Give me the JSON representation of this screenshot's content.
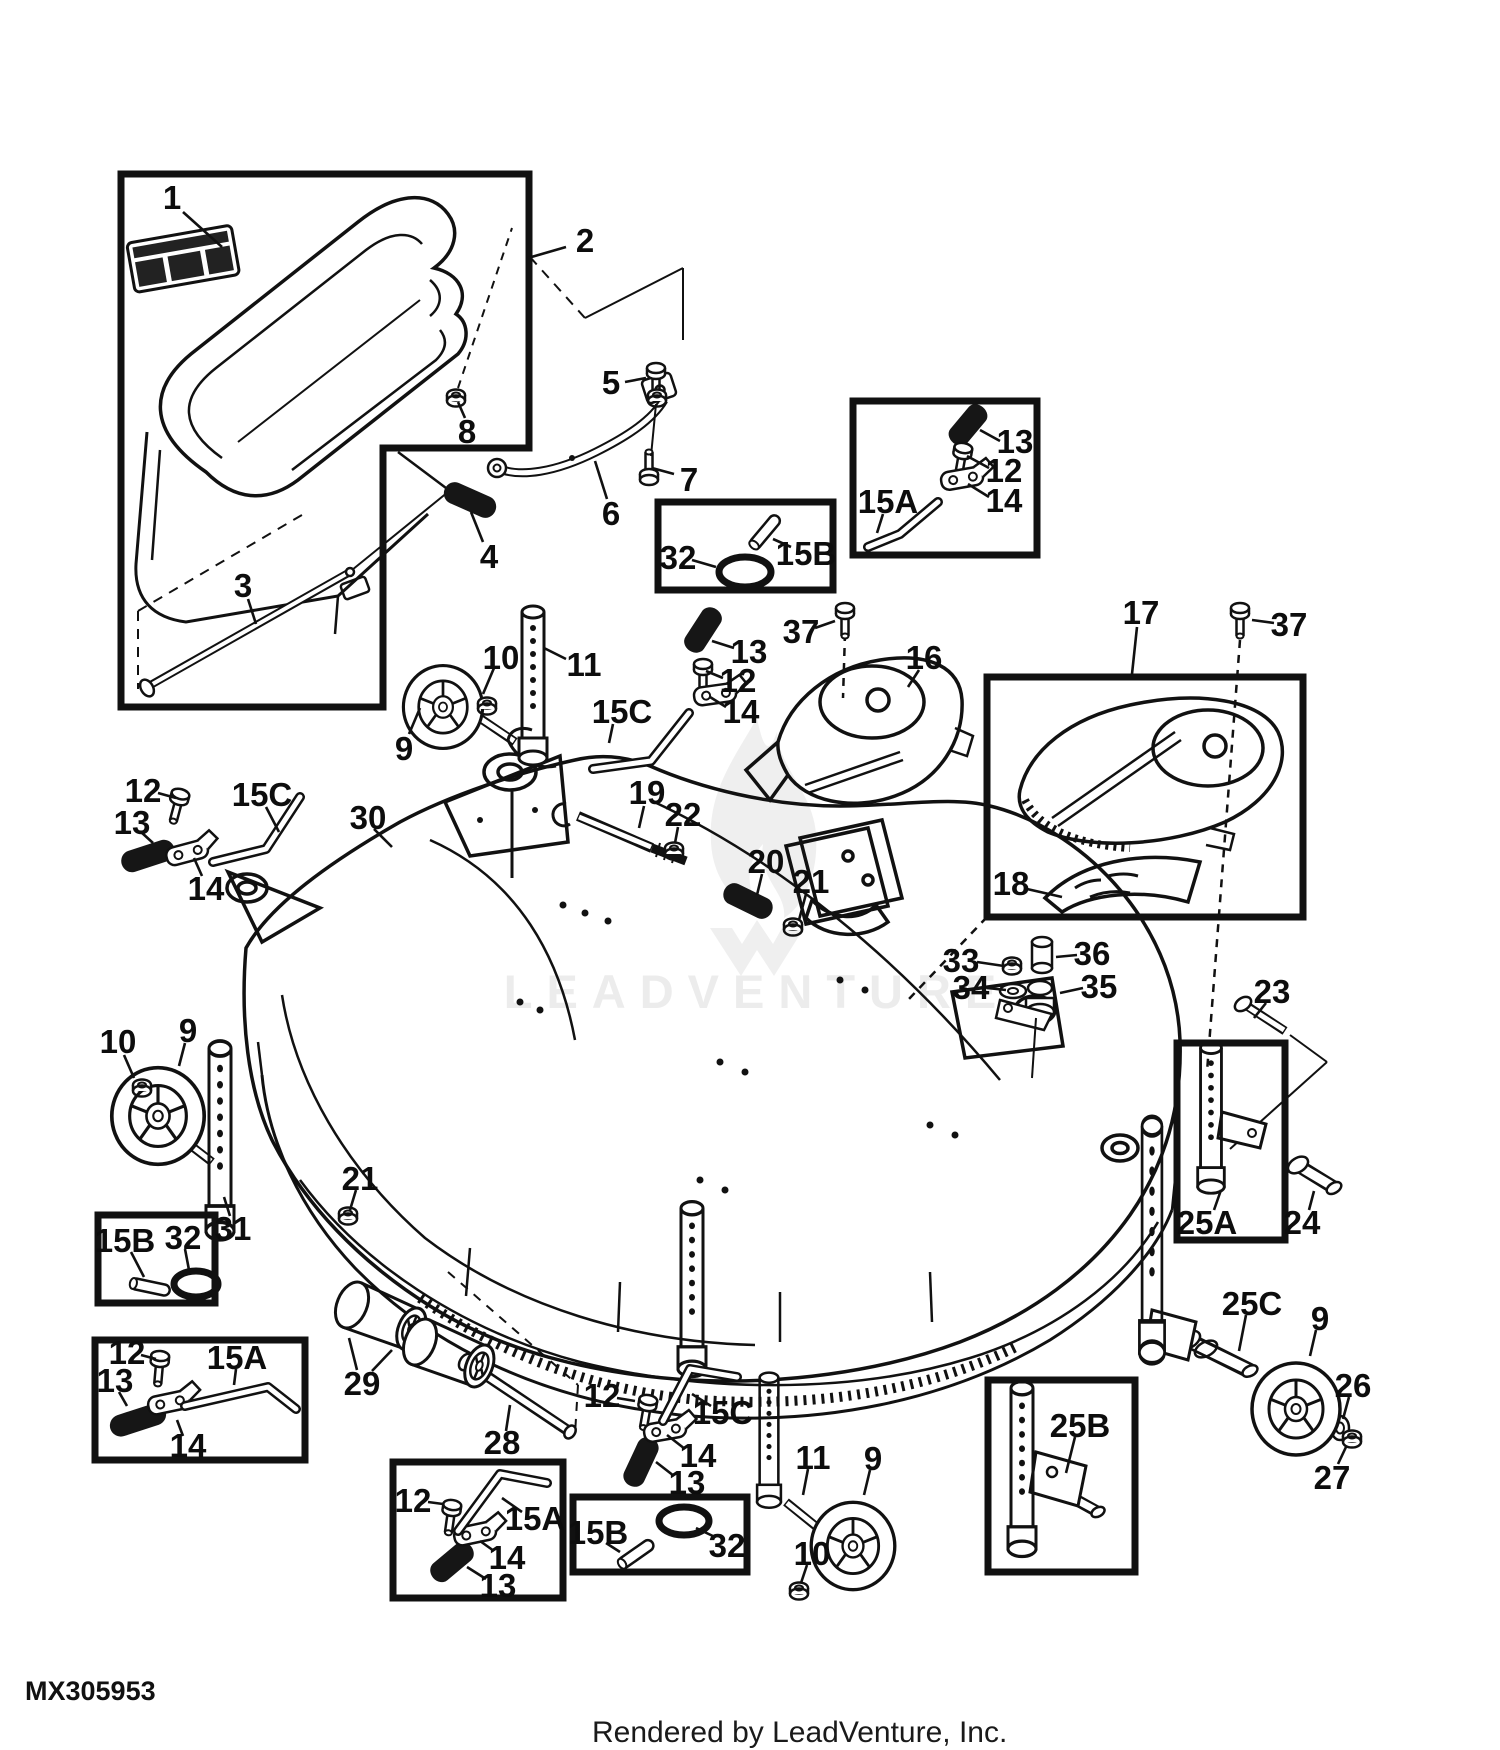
{
  "footer": {
    "part_code": "MX305953",
    "credit": "Rendered by LeadVenture, Inc."
  },
  "watermark": {
    "text": "LEADVENTURE"
  },
  "palette": {
    "line": "#111111",
    "background": "#ffffff",
    "watermark": "#ececec"
  },
  "inset_boxes": [
    {
      "name": "inset-box-chute",
      "points": "121,174 529,174 529,448 383,448 383,707 121,707"
    },
    {
      "name": "inset-box-15a-top",
      "x": 853,
      "y": 401,
      "w": 184,
      "h": 154
    },
    {
      "name": "inset-box-15b-top",
      "x": 658,
      "y": 502,
      "w": 175,
      "h": 88
    },
    {
      "name": "inset-box-cover-17",
      "x": 987,
      "y": 677,
      "w": 316,
      "h": 240
    },
    {
      "name": "inset-box-25a",
      "x": 1177,
      "y": 1043,
      "w": 108,
      "h": 197
    },
    {
      "name": "inset-box-15b-left",
      "x": 98,
      "y": 1215,
      "w": 117,
      "h": 88
    },
    {
      "name": "inset-box-15a-left",
      "x": 95,
      "y": 1340,
      "w": 210,
      "h": 120
    },
    {
      "name": "inset-box-15a-bottom",
      "x": 393,
      "y": 1462,
      "w": 170,
      "h": 136
    },
    {
      "name": "inset-box-15b-bottom",
      "x": 573,
      "y": 1497,
      "w": 174,
      "h": 75
    },
    {
      "name": "inset-box-25b",
      "x": 988,
      "y": 1380,
      "w": 147,
      "h": 192
    }
  ],
  "callouts": [
    {
      "t": "1",
      "x": 172,
      "y": 197,
      "l": [
        [
          183,
          212,
          222,
          247
        ]
      ]
    },
    {
      "t": "2",
      "x": 585,
      "y": 240,
      "l": [
        [
          566,
          247,
          528,
          258
        ]
      ]
    },
    {
      "t": "3",
      "x": 243,
      "y": 585,
      "l": [
        [
          248,
          599,
          256,
          624
        ]
      ]
    },
    {
      "t": "4",
      "x": 489,
      "y": 556,
      "l": [
        [
          483,
          542,
          471,
          512
        ]
      ]
    },
    {
      "t": "5",
      "x": 611,
      "y": 382,
      "l": [
        [
          625,
          382,
          646,
          378
        ]
      ]
    },
    {
      "t": "6",
      "x": 611,
      "y": 513,
      "l": [
        [
          607,
          499,
          595,
          461
        ]
      ]
    },
    {
      "t": "7",
      "x": 689,
      "y": 479,
      "l": [
        [
          674,
          474,
          652,
          468
        ]
      ]
    },
    {
      "t": "8",
      "x": 467,
      "y": 431,
      "l": [
        [
          465,
          418,
          458,
          402
        ]
      ]
    },
    {
      "t": "9",
      "x": 404,
      "y": 748,
      "l": [
        [
          409,
          734,
          420,
          708
        ]
      ]
    },
    {
      "t": "10",
      "x": 501,
      "y": 657,
      "l": [
        [
          494,
          668,
          483,
          694
        ]
      ]
    },
    {
      "t": "11",
      "x": 584,
      "y": 664,
      "l": [
        [
          566,
          659,
          544,
          648
        ]
      ]
    },
    {
      "t": "12",
      "x": 143,
      "y": 790,
      "l": [
        [
          158,
          793,
          176,
          798
        ]
      ]
    },
    {
      "t": "13",
      "x": 132,
      "y": 822,
      "l": [
        [
          141,
          832,
          153,
          843
        ]
      ]
    },
    {
      "t": "14",
      "x": 206,
      "y": 888,
      "l": [
        [
          202,
          876,
          194,
          858
        ]
      ]
    },
    {
      "t": "15C",
      "x": 262,
      "y": 794,
      "l": [
        [
          266,
          807,
          279,
          832
        ]
      ]
    },
    {
      "t": "30",
      "x": 368,
      "y": 817,
      "l": [
        [
          374,
          829,
          392,
          847
        ]
      ]
    },
    {
      "t": "13",
      "x": 1015,
      "y": 441,
      "l": [
        [
          1000,
          441,
          980,
          430
        ]
      ]
    },
    {
      "t": "12",
      "x": 1004,
      "y": 470,
      "l": [
        [
          989,
          468,
          967,
          456
        ]
      ]
    },
    {
      "t": "14",
      "x": 1004,
      "y": 500,
      "l": [
        [
          989,
          497,
          968,
          484
        ]
      ]
    },
    {
      "t": "15A",
      "x": 888,
      "y": 501,
      "l": [
        [
          883,
          514,
          877,
          533
        ]
      ]
    },
    {
      "t": "32",
      "x": 678,
      "y": 557,
      "l": [
        [
          692,
          560,
          716,
          567
        ]
      ]
    },
    {
      "t": "15B",
      "x": 806,
      "y": 553,
      "l": [
        [
          791,
          547,
          773,
          539
        ]
      ]
    },
    {
      "t": "13",
      "x": 749,
      "y": 651,
      "l": [
        [
          734,
          648,
          712,
          641
        ]
      ]
    },
    {
      "t": "12",
      "x": 738,
      "y": 680,
      "l": [
        [
          723,
          678,
          706,
          671
        ]
      ]
    },
    {
      "t": "14",
      "x": 741,
      "y": 711,
      "l": [
        [
          726,
          707,
          710,
          697
        ]
      ]
    },
    {
      "t": "15C",
      "x": 622,
      "y": 711,
      "l": [
        [
          613,
          724,
          609,
          743
        ]
      ]
    },
    {
      "t": "37",
      "x": 801,
      "y": 631,
      "l": [
        [
          815,
          628,
          835,
          621
        ]
      ]
    },
    {
      "t": "19",
      "x": 647,
      "y": 792,
      "l": [
        [
          644,
          806,
          639,
          828
        ]
      ]
    },
    {
      "t": "22",
      "x": 683,
      "y": 814,
      "l": [
        [
          678,
          827,
          675,
          843
        ]
      ]
    },
    {
      "t": "20",
      "x": 766,
      "y": 861,
      "l": [
        [
          762,
          874,
          757,
          895
        ]
      ]
    },
    {
      "t": "21",
      "x": 811,
      "y": 881,
      "l": [
        [
          806,
          894,
          799,
          920
        ]
      ]
    },
    {
      "t": "16",
      "x": 924,
      "y": 657,
      "l": [
        [
          919,
          670,
          908,
          687
        ]
      ]
    },
    {
      "t": "17",
      "x": 1141,
      "y": 612,
      "l": [
        [
          1137,
          627,
          1132,
          674
        ]
      ]
    },
    {
      "t": "37",
      "x": 1289,
      "y": 624,
      "l": [
        [
          1274,
          623,
          1252,
          620
        ]
      ]
    },
    {
      "t": "18",
      "x": 1011,
      "y": 883,
      "l": [
        [
          1027,
          889,
          1062,
          897
        ]
      ]
    },
    {
      "t": "33",
      "x": 961,
      "y": 960,
      "l": [
        [
          977,
          962,
          1004,
          966
        ]
      ]
    },
    {
      "t": "34",
      "x": 971,
      "y": 987,
      "l": [
        [
          987,
          988,
          1006,
          990
        ]
      ]
    },
    {
      "t": "36",
      "x": 1092,
      "y": 953,
      "l": [
        [
          1077,
          955,
          1056,
          957
        ]
      ]
    },
    {
      "t": "35",
      "x": 1099,
      "y": 986,
      "l": [
        [
          1083,
          988,
          1060,
          993
        ]
      ]
    },
    {
      "t": "23",
      "x": 1272,
      "y": 991,
      "l": [
        [
          1266,
          1003,
          1254,
          1018
        ]
      ]
    },
    {
      "t": "25A",
      "x": 1207,
      "y": 1222,
      "l": [
        [
          1214,
          1210,
          1221,
          1190
        ]
      ]
    },
    {
      "t": "24",
      "x": 1302,
      "y": 1222,
      "l": [
        [
          1309,
          1210,
          1314,
          1191
        ]
      ]
    },
    {
      "t": "10",
      "x": 118,
      "y": 1041,
      "l": [
        [
          124,
          1055,
          134,
          1078
        ]
      ]
    },
    {
      "t": "9",
      "x": 188,
      "y": 1030,
      "l": [
        [
          185,
          1043,
          179,
          1066
        ]
      ]
    },
    {
      "t": "31",
      "x": 233,
      "y": 1228,
      "l": [
        [
          230,
          1216,
          224,
          1197
        ]
      ]
    },
    {
      "t": "21",
      "x": 360,
      "y": 1178,
      "l": [
        [
          356,
          1190,
          350,
          1210
        ]
      ]
    },
    {
      "t": "15B",
      "x": 125,
      "y": 1240,
      "l": [
        [
          131,
          1252,
          144,
          1277
        ]
      ]
    },
    {
      "t": "32",
      "x": 183,
      "y": 1237,
      "l": [
        [
          185,
          1249,
          189,
          1270
        ]
      ]
    },
    {
      "t": "12",
      "x": 127,
      "y": 1352,
      "l": [
        [
          141,
          1355,
          156,
          1359
        ]
      ]
    },
    {
      "t": "13",
      "x": 115,
      "y": 1380,
      "l": [
        [
          119,
          1392,
          127,
          1406
        ]
      ]
    },
    {
      "t": "15A",
      "x": 237,
      "y": 1357,
      "l": [
        [
          236,
          1369,
          234,
          1385
        ]
      ]
    },
    {
      "t": "14",
      "x": 188,
      "y": 1445,
      "l": [
        [
          183,
          1436,
          177,
          1420
        ]
      ]
    },
    {
      "t": "29",
      "x": 362,
      "y": 1383,
      "l": [
        [
          357,
          1370,
          349,
          1338
        ],
        [
          372,
          1371,
          392,
          1350
        ]
      ]
    },
    {
      "t": "28",
      "x": 502,
      "y": 1442,
      "l": [
        [
          506,
          1431,
          510,
          1405
        ]
      ]
    },
    {
      "t": "12",
      "x": 602,
      "y": 1395,
      "l": [
        [
          617,
          1398,
          635,
          1401
        ]
      ]
    },
    {
      "t": "15C",
      "x": 723,
      "y": 1412,
      "l": [
        [
          711,
          1406,
          692,
          1394
        ]
      ]
    },
    {
      "t": "14",
      "x": 698,
      "y": 1455,
      "l": [
        [
          685,
          1449,
          667,
          1435
        ]
      ]
    },
    {
      "t": "13",
      "x": 687,
      "y": 1482,
      "l": [
        [
          674,
          1476,
          656,
          1462
        ]
      ]
    },
    {
      "t": "12",
      "x": 413,
      "y": 1500,
      "l": [
        [
          428,
          1502,
          443,
          1504
        ]
      ]
    },
    {
      "t": "15A",
      "x": 535,
      "y": 1518,
      "l": [
        [
          522,
          1512,
          502,
          1498
        ]
      ]
    },
    {
      "t": "14",
      "x": 507,
      "y": 1557,
      "l": [
        [
          494,
          1551,
          480,
          1541
        ]
      ]
    },
    {
      "t": "13",
      "x": 498,
      "y": 1585,
      "l": [
        [
          486,
          1579,
          467,
          1567
        ]
      ]
    },
    {
      "t": "15B",
      "x": 598,
      "y": 1532,
      "l": [
        [
          606,
          1543,
          620,
          1552
        ]
      ]
    },
    {
      "t": "32",
      "x": 727,
      "y": 1545,
      "l": [
        [
          715,
          1537,
          696,
          1528
        ]
      ]
    },
    {
      "t": "11",
      "x": 813,
      "y": 1457,
      "l": [
        [
          808,
          1469,
          803,
          1495
        ]
      ]
    },
    {
      "t": "9",
      "x": 873,
      "y": 1458,
      "l": [
        [
          870,
          1470,
          864,
          1495
        ]
      ]
    },
    {
      "t": "10",
      "x": 812,
      "y": 1553,
      "l": [
        [
          807,
          1565,
          801,
          1583
        ]
      ]
    },
    {
      "t": "25C",
      "x": 1252,
      "y": 1303,
      "l": [
        [
          1246,
          1315,
          1239,
          1351
        ]
      ]
    },
    {
      "t": "9",
      "x": 1320,
      "y": 1318,
      "l": [
        [
          1316,
          1330,
          1310,
          1356
        ]
      ]
    },
    {
      "t": "26",
      "x": 1353,
      "y": 1385,
      "l": [
        [
          1349,
          1397,
          1343,
          1419
        ]
      ]
    },
    {
      "t": "27",
      "x": 1332,
      "y": 1477,
      "l": [
        [
          1338,
          1464,
          1346,
          1447
        ]
      ]
    },
    {
      "t": "25B",
      "x": 1080,
      "y": 1425,
      "l": [
        [
          1075,
          1437,
          1066,
          1473
        ]
      ]
    }
  ]
}
